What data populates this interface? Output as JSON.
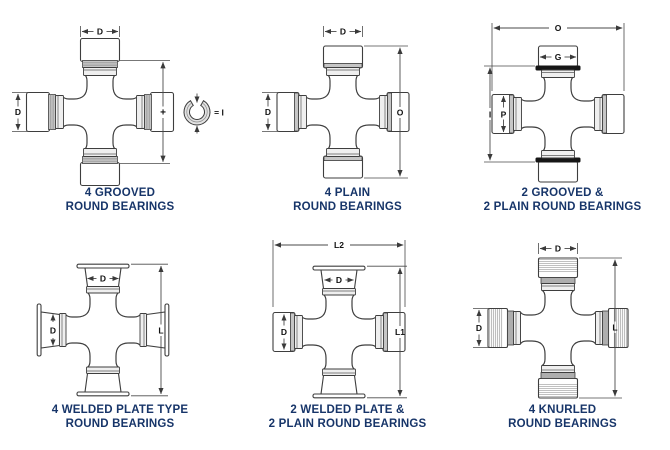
{
  "figure_title": "Universal joint bearing type diagrams",
  "colors": {
    "caption": "#173569",
    "line": "#3e3e3e",
    "groove_ring": "#161616",
    "shade": "#c6c6c6"
  },
  "diagrams": [
    {
      "id": "4-grooved",
      "caption_line1": "4 GROOVED",
      "caption_line2": "ROUND BEARINGS",
      "dims": {
        "top": "D",
        "left": "D",
        "mid": "+",
        "equals": "= I"
      }
    },
    {
      "id": "4-plain",
      "caption_line1": "4 PLAIN",
      "caption_line2": "ROUND BEARINGS",
      "dims": {
        "top": "D",
        "left": "D",
        "right": "O"
      }
    },
    {
      "id": "2-grooved-2-plain",
      "caption_line1": "2 GROOVED &",
      "caption_line2": "2 PLAIN ROUND BEARINGS",
      "dims": {
        "top": "O",
        "cup_top": "G",
        "left": "I",
        "cup_left": "P"
      }
    },
    {
      "id": "4-welded-plate",
      "caption_line1": "4 WELDED PLATE TYPE",
      "caption_line2": "ROUND BEARINGS",
      "dims": {
        "cup_top": "D",
        "cup_left": "D",
        "right": "L"
      }
    },
    {
      "id": "2-welded-2-plain",
      "caption_line1": "2 WELDED PLATE &",
      "caption_line2": "2 PLAIN ROUND BEARINGS",
      "dims": {
        "top": "L2",
        "cup_top": "D",
        "cup_left": "D",
        "right": "L1"
      }
    },
    {
      "id": "4-knurled",
      "caption_line1": "4 KNURLED",
      "caption_line2": "ROUND BEARINGS",
      "dims": {
        "top": "D",
        "left": "D",
        "right": "L"
      }
    }
  ]
}
